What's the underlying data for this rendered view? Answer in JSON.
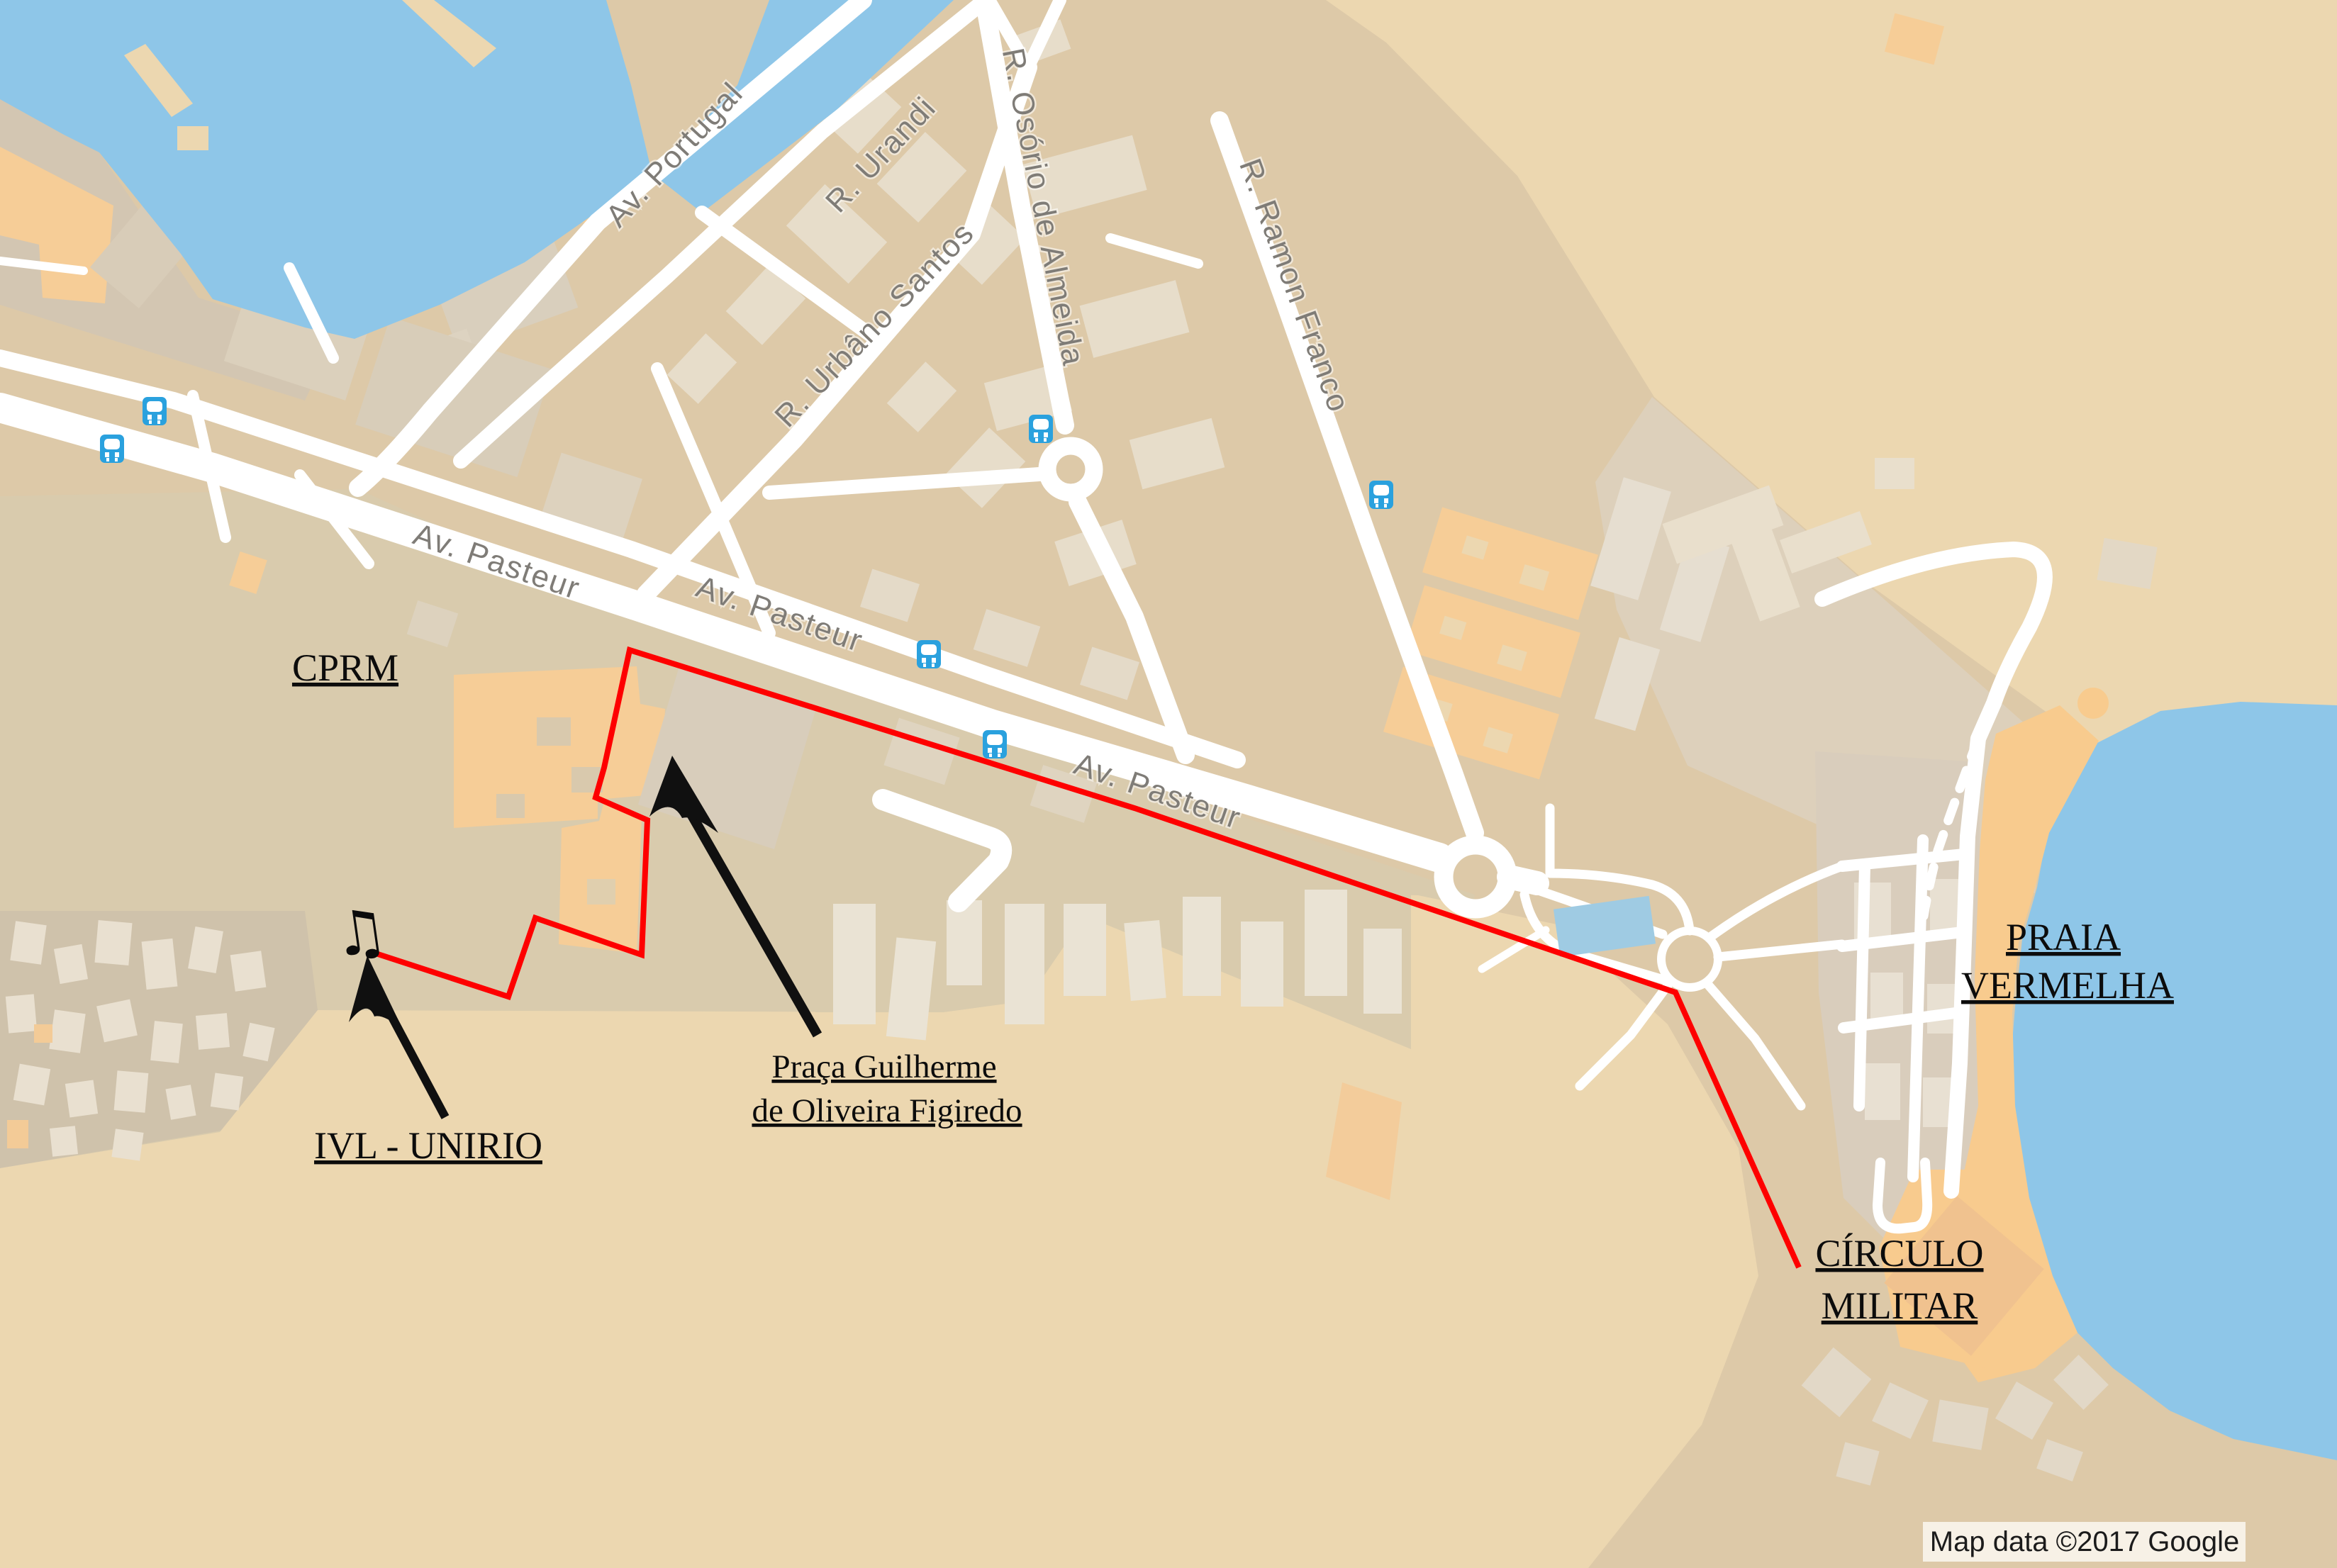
{
  "map": {
    "streets": {
      "av_portugal": "Av. Portugal",
      "r_urandi": "R. Urandi",
      "r_urbano_santos": "R. Urbâno Santos",
      "r_osorio_de_almeida": "R. Osório de Almeida",
      "r_ramon_franco": "R. Ramon Franco",
      "av_pasteur_1": "Av. Pasteur",
      "av_pasteur_2": "Av. Pasteur",
      "av_pasteur_3": "Av. Pasteur"
    },
    "annotations": {
      "cprm": "CPRM",
      "ivl_unirio": "IVL - UNIRIO",
      "praca_line1": "Praça Guilherme",
      "praca_line2": "de Oliveira Figiredo",
      "praia_line1": "PRAIA",
      "praia_line2": "VERMELHA",
      "circulo_line1": "CÍRCULO",
      "circulo_line2": "MILITAR"
    },
    "icons": {
      "music_note_glyph": "♫",
      "bus_stop": "bus-stop-icon"
    },
    "attribution": "Map data ©2017 Google",
    "colors": {
      "land": "#ddc9a8",
      "open_land": "#ecd7b0",
      "urban_shade": "#d9cbad",
      "favela_shade": "#cfc2ab",
      "water": "#8ec6e8",
      "pool": "#9fcbe3",
      "beach_sand": "#f8cb8e",
      "building_light": "#e8dfcf",
      "building_orange": "#f6cd97",
      "road_white": "#ffffff",
      "route_red": "#fe0000",
      "bus_blue": "#2aa1de",
      "street_label_gray": "#7f7c77",
      "annotation_black": "#0c0c0c",
      "attribution_bg": "#f7f1e6"
    }
  }
}
